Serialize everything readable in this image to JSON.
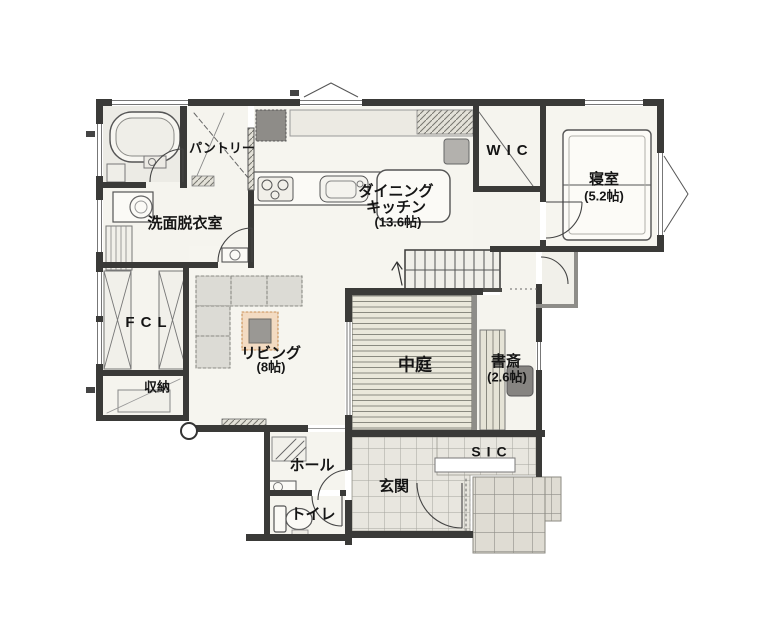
{
  "rooms": {
    "washroom": {
      "label": "洗面脱衣室"
    },
    "pantry": {
      "label": "パントリー"
    },
    "dining_kitchen": {
      "label_line1": "ダイニング",
      "label_line2": "キッチン",
      "size": "(13.6帖)"
    },
    "wic": {
      "label": "WIC"
    },
    "bedroom": {
      "label": "寝室",
      "size": "(5.2帖)"
    },
    "fcl": {
      "label": "FCL"
    },
    "living": {
      "label": "リビング",
      "size": "(8帖)"
    },
    "courtyard": {
      "label": "中庭"
    },
    "study": {
      "label": "書斎",
      "size": "(2.6帖)"
    },
    "storage": {
      "label": "収納"
    },
    "hall": {
      "label": "ホール"
    },
    "entrance": {
      "label": "玄関"
    },
    "toilet": {
      "label": "トイレ"
    },
    "sic": {
      "label": "SIC"
    }
  },
  "fixtures": [
    "bathtub",
    "washing-machine",
    "linen-shelf",
    "hand-basin",
    "kitchen-counter",
    "stove",
    "sink",
    "refrigerator",
    "cupboard",
    "stool",
    "dining-table",
    "sofa",
    "rug",
    "coffee-table",
    "tv-board",
    "bed",
    "wic-hanger-pipe",
    "stairs",
    "wood-deck",
    "desk-counter",
    "desk-chair",
    "toilet",
    "toilet-hand-basin",
    "entrance-door",
    "sic-shelf",
    "porch-tiles",
    "storage-shelf",
    "fcl-closets",
    "structural-column"
  ],
  "colors": {
    "wall": "#3a3a38",
    "thin_wall": "#8e8d89",
    "floor": "#f5f4ee",
    "bath_floor": "#ecebe5",
    "deck": "#eae8db",
    "entrance_tile": "#e8e6df",
    "porch_tile": "#dfdcd3",
    "fridge": "#8e8c88",
    "sofa": "#dcdbd5",
    "rug": "#f3dbc2",
    "rug_border": "#c98f55",
    "text": "#151515"
  }
}
